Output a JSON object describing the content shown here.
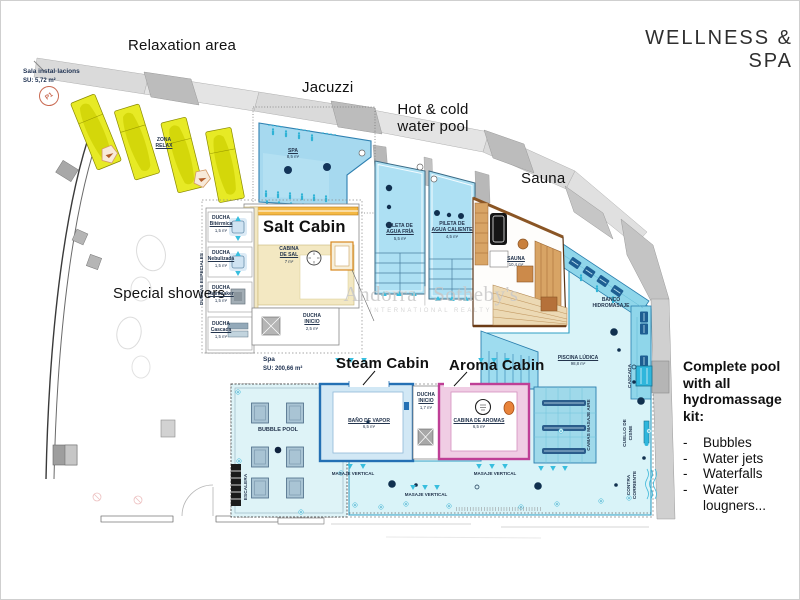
{
  "title": "WELLNESS  &  SPA",
  "watermark": {
    "main": "Andorra | Sotheby's",
    "sub": "INTERNATIONAL REALTY"
  },
  "annotations": {
    "relaxation_area": "Relaxation area",
    "jacuzzi": "Jacuzzi",
    "hot_cold_1": "Hot & cold",
    "hot_cold_2": "water pool",
    "sauna": "Sauna",
    "salt_cabin": "Salt Cabin",
    "special_showers": "Special showers",
    "steam_cabin": "Steam Cabin",
    "aroma_cabin": "Aroma Cabin"
  },
  "info_block": {
    "heading_1": "Complete pool with all",
    "heading_2": "hydromassage kit:",
    "bullet": "-",
    "items": [
      "Bubbles",
      "Water jets",
      "Waterfalls",
      "Water lougners..."
    ]
  },
  "rooms": {
    "sala_instalacions": {
      "name": "Sala instal·lacions",
      "area": "SU: 5,72 m²"
    },
    "spa_zone": {
      "name": "Spa",
      "area": "SU: 200,66 m²"
    },
    "zona_relax": {
      "l1": "ZONA",
      "l2": "RELAX"
    },
    "p1_marker": "P1",
    "spa_pool": {
      "name": "SPA",
      "area": "8,5 m²"
    },
    "pileta_fria": {
      "l1": "PILETA DE",
      "l2": "AGUA FRÍA",
      "area": "5,5 m²"
    },
    "pileta_caliente": {
      "l1": "PILETA DE",
      "l2": "AGUA CALIENTE",
      "area": "4,5 m²"
    },
    "sauna_room": {
      "name": "SAUNA",
      "area": "10,4 m²"
    },
    "cabina_sal": {
      "l1": "CABINA",
      "l2": "DE SAL",
      "area": "7 m²"
    },
    "ducha_inicio": {
      "l1": "DUCHA",
      "l2": "INICIO",
      "area": "2,5 m²"
    },
    "ducha_inicio_small": {
      "l1": "DUCHA",
      "l2": "INICIO",
      "area": "1,7 m²"
    },
    "bano_vapor": {
      "name": "BAÑO DE VAPOR",
      "area": "6,5 m²"
    },
    "cabina_aromas": {
      "name": "CABINA DE AROMAS",
      "area": "6,5 m²"
    },
    "bubble_pool": "BUBBLE POOL",
    "escalera": "ESCALERA",
    "duchas_especiales": "DUCHAS ESPECIALES",
    "piscina_ludica": {
      "name": "PISCINA LÚDICA",
      "area": "98,8 m²"
    },
    "banco_hidromasaje": {
      "l1": "BANCO",
      "l2": "HIDROMASAJE"
    },
    "camas_masaje_aire": "CAMAS MASAJE AIRE",
    "cascada": "CASCADA",
    "cuello_cisne": {
      "l1": "CUELLO DE",
      "l2": "CISNE"
    },
    "contra_corriente": {
      "l1": "CONTRA",
      "l2": "CORRIENTE"
    },
    "masaje_vertical": "MASAJE VERTICAL"
  },
  "showers": [
    {
      "name": "DUCHA",
      "type": "Bitérmica",
      "area": "1,5 m²"
    },
    {
      "name": "DUCHA",
      "type": "Nebulizada",
      "area": "1,5 m²"
    },
    {
      "name": "DUCHA",
      "type": "Rainmaker",
      "area": "1,5 m²"
    },
    {
      "name": "DUCHA",
      "type": "Cascada",
      "area": "1,5 m²"
    }
  ],
  "colors": {
    "pool_water": "#a6d9ef",
    "pool_deck": "#d9f3f8",
    "hydro_bench": "#8fd6ea",
    "seat_navy": "#1d5e92",
    "jet_cyan": "#38bede",
    "lounger_yellow": "#e7ea25",
    "sauna_wood": "#d8a465",
    "salt_cream": "#f3e8c2",
    "salt_orange": "#f4b844",
    "steam_blue": "#2470b4",
    "aroma_pink": "#bf3f96",
    "wall_gray": "#d9d9d9"
  }
}
